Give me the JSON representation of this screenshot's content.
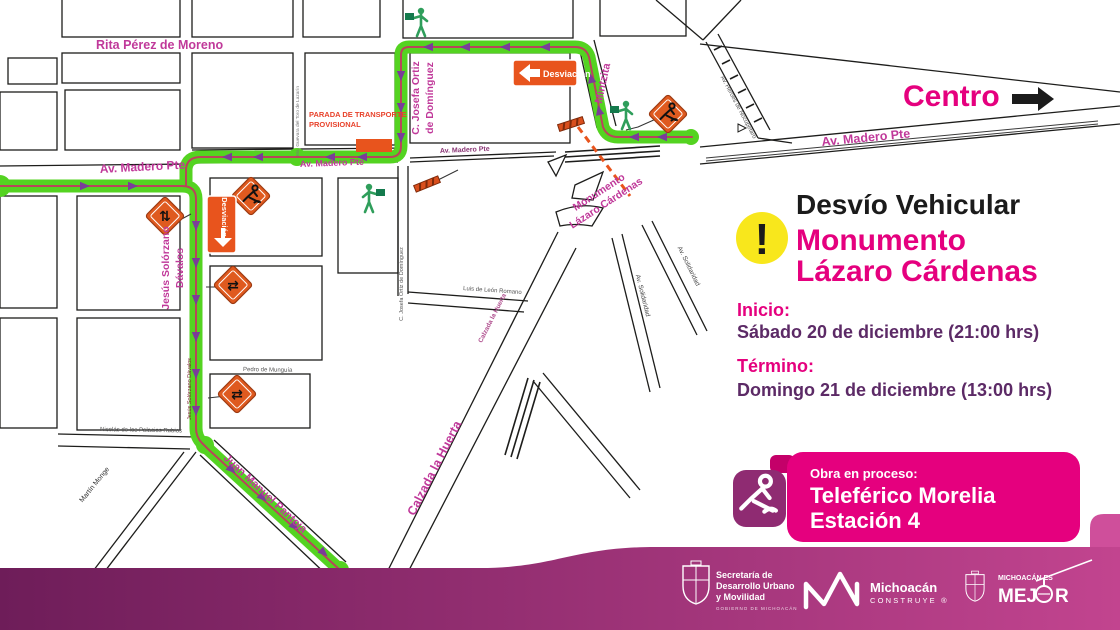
{
  "colors": {
    "accent_pink": "#e5007e",
    "detour_green": "#54d321",
    "arrow_purple": "#7a3d99",
    "sign_orange": "#e8541d",
    "footer_left": "#6e1d59",
    "footer_right": "#c2448f",
    "date_purple": "#5c2a66",
    "alert_yellow": "#f8e71c"
  },
  "map": {
    "centro_label": "Centro",
    "streets": {
      "rita": "Rita Pérez de Moreno",
      "madero": "Av. Madero Pte",
      "josefa_l1": "C. Josefa Ortiz",
      "josefa_l2": "de Domínguez",
      "josefa_small": "C. Josefa Ortiz de Domínguez",
      "mintzita": "Mintzita",
      "solorzano_l1": "Jesús Solórzano",
      "solorzano_l2": "Dávalos",
      "solorzano_small": "Jesús Solórzano Dávalos",
      "pantoja": "Juan Manuel Pantoja",
      "huerta": "Calzada la Huerta",
      "monumento_l1": "Monumento",
      "monumento_l2": "Lázaro Cárdenas",
      "solidaridad": "Av. Solidaridad",
      "nocupetaro": "Av. Héroes de Nocupétaro",
      "luis": "Luis de León Romano",
      "monge": "Martín Monge",
      "palacios": "Nicolás de los Palacios Rubios",
      "munguia": "Pedro de Munguía",
      "guevara": "Ma. Guevara del Toro de Lazarín"
    },
    "signs": {
      "desviacion": "Desviación",
      "parada_l1": "PARADA DE TRANSPORTE",
      "parada_l2": "PROVISIONAL"
    },
    "icons": {
      "two_way_vertical": "⇅",
      "two_way_horizontal": "⇄"
    }
  },
  "panel": {
    "alert": "!",
    "title": "Desvío Vehicular",
    "subject_l1": "Monumento",
    "subject_l2": "Lázaro Cárdenas",
    "start_label": "Inicio:",
    "start_value": "Sábado 20 de diciembre (21:00 hrs)",
    "end_label": "Término:",
    "end_value": "Domingo 21 de diciembre (13:00 hrs)"
  },
  "obra": {
    "kicker": "Obra en proceso:",
    "line1": "Teleférico Morelia",
    "line2": "Estación 4"
  },
  "footer": {
    "sedum_l1": "Secretaría de",
    "sedum_l2": "Desarrollo Urbano",
    "sedum_l3": "y Movilidad",
    "sedum_sub": "GOBIERNO DE MICHOACÁN",
    "construye_l1": "Michoacán",
    "construye_l2": "CONSTRUYE ®",
    "mejor_kicker": "MICHOACÁN ES",
    "mejor_pre": "MEJ",
    "mejor_post": "R"
  }
}
